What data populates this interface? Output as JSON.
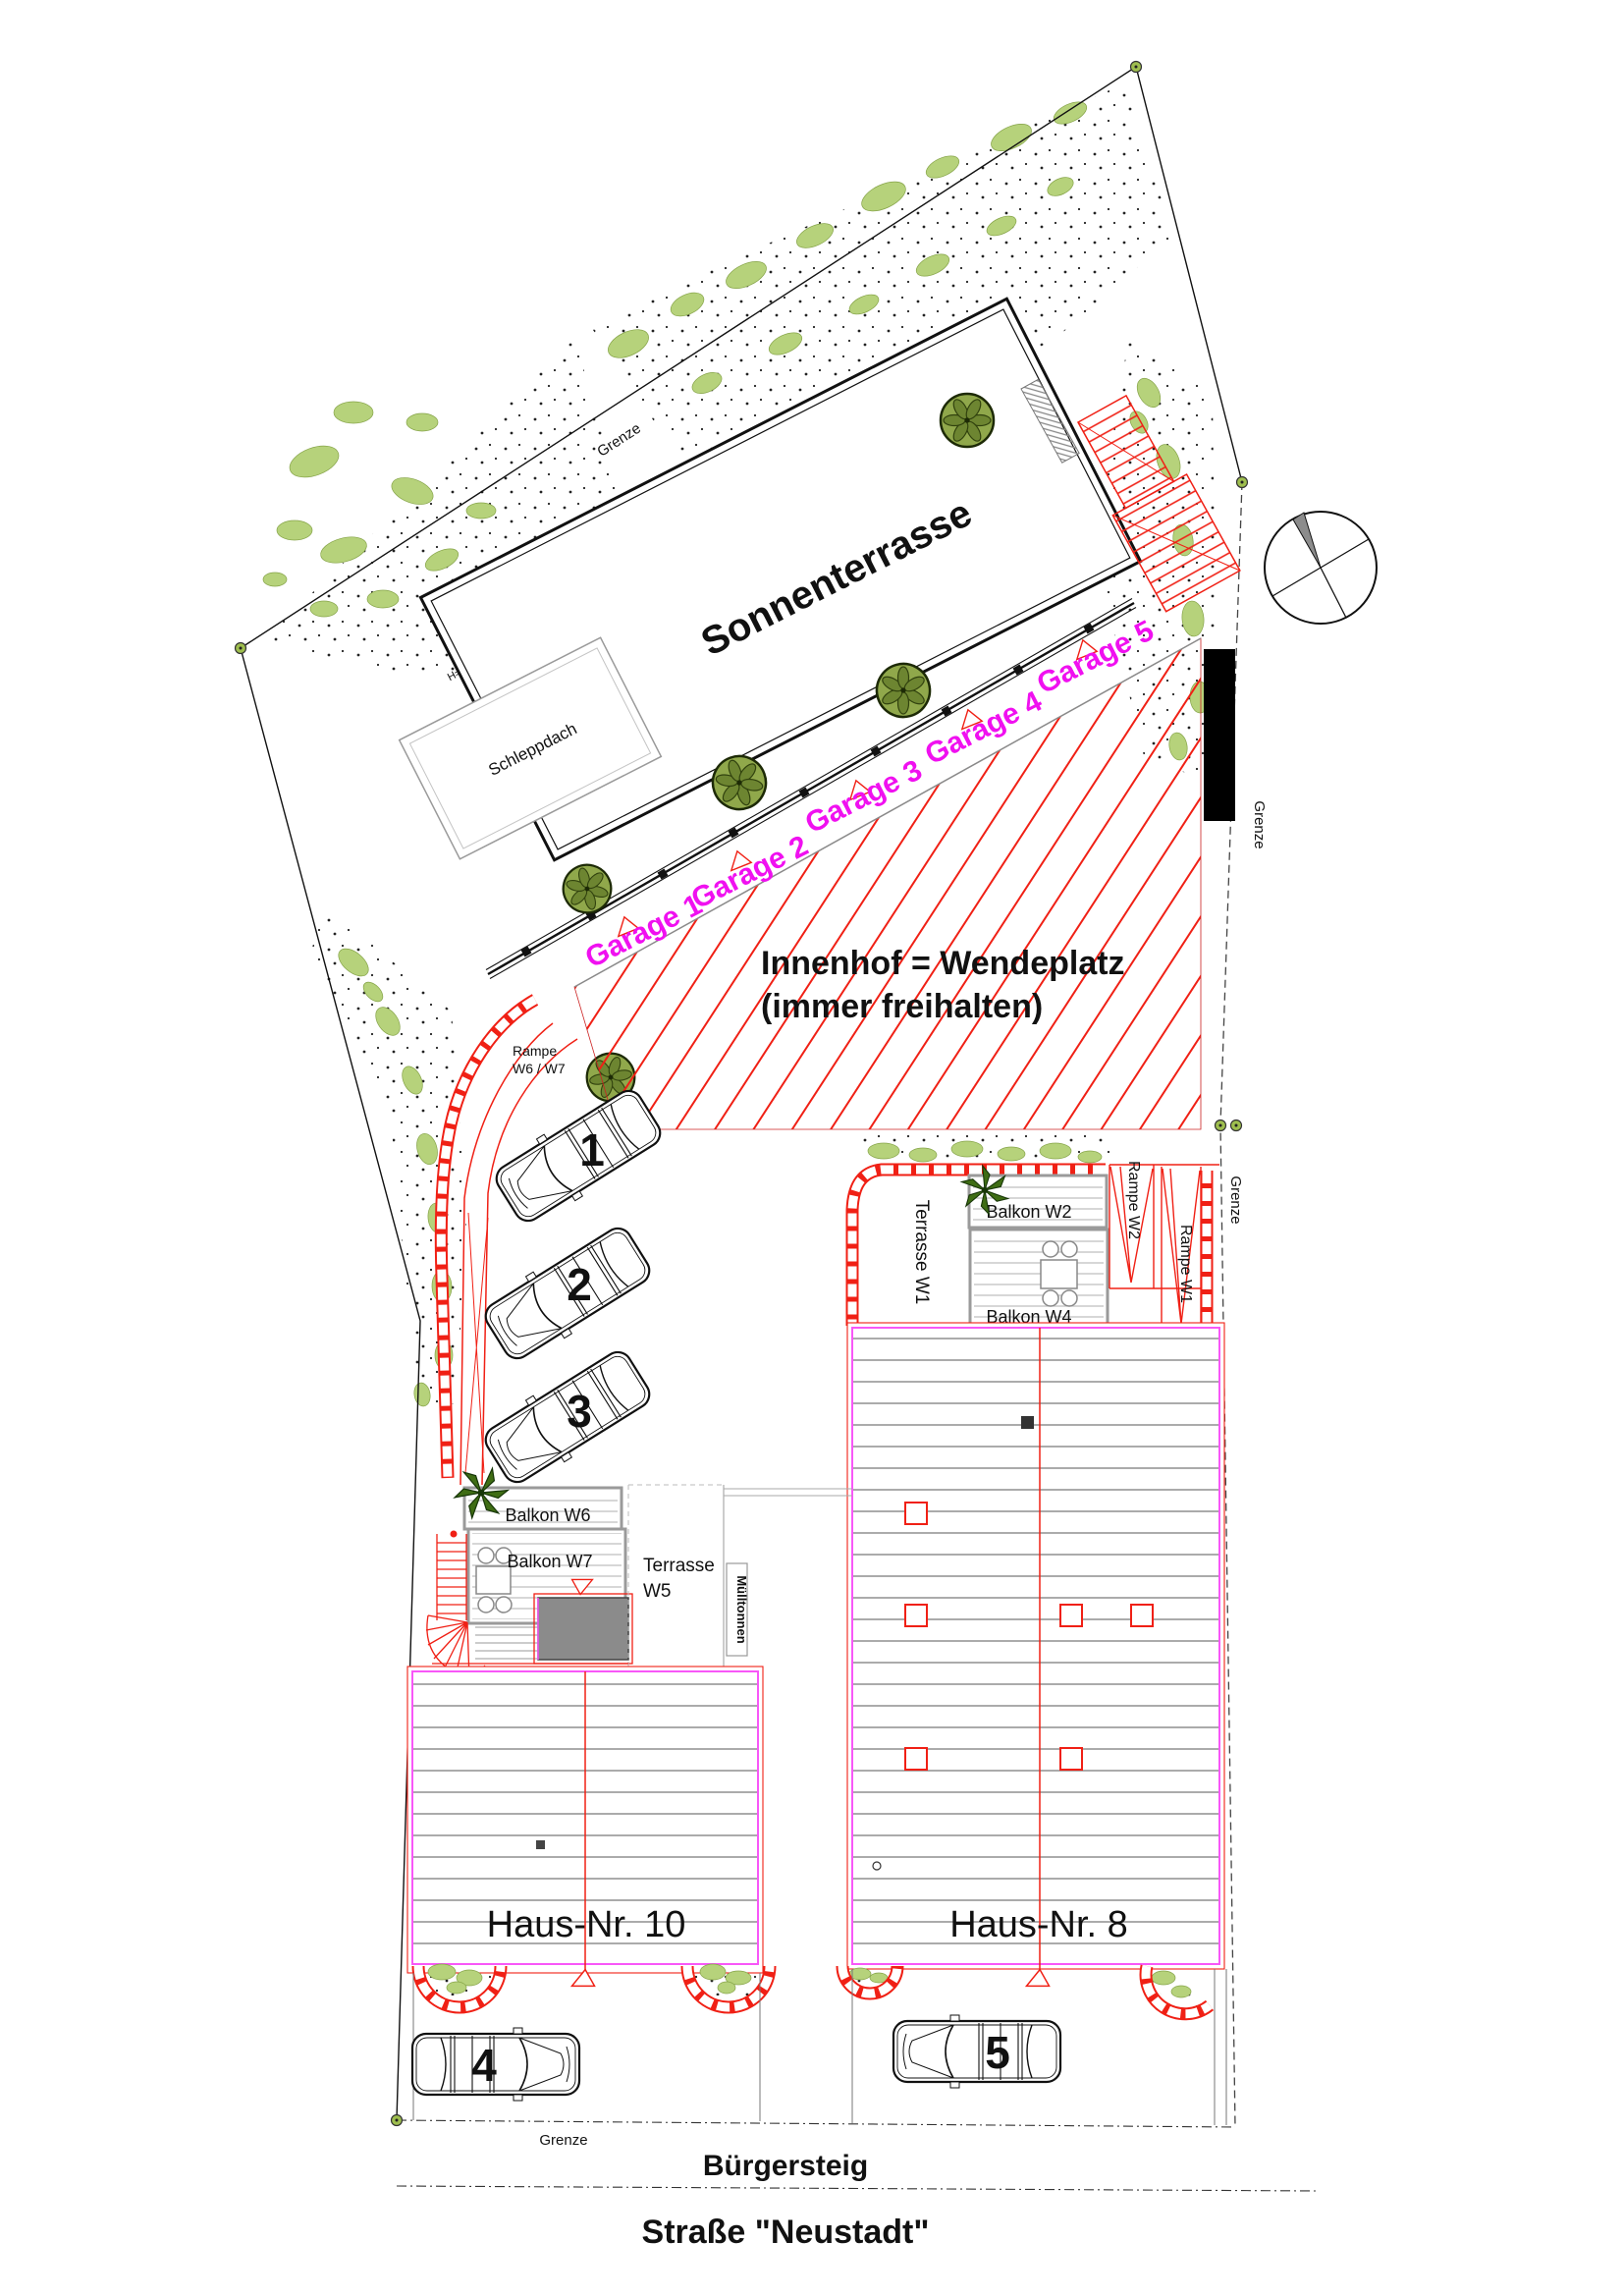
{
  "plan": {
    "areas": {
      "sonnenterrasse": "Sonnenterrasse",
      "schleppdach": "Schleppdach",
      "innenhof_line1": "Innenhof = Wendeplatz",
      "innenhof_line2": "(immer freihalten)",
      "terrasse_w1": "Terrasse W1",
      "terrasse_w5_line1": "Terrasse",
      "terrasse_w5_line2": "W5",
      "balkon_w2": "Balkon W2",
      "balkon_w4": "Balkon W4",
      "balkon_w6": "Balkon W6",
      "balkon_w7": "Balkon W7",
      "rampe_w6_w7_line1": "Rampe",
      "rampe_w6_w7_line2": "W6 / W7",
      "rampe_w2": "Rampe W2",
      "rampe_w1": "Rampe W1",
      "muelltonnen": "Mülltonnen"
    },
    "garages": [
      "Garage 1",
      "Garage 2",
      "Garage 3",
      "Garage 4",
      "Garage 5"
    ],
    "houses": {
      "haus10": "Haus-Nr. 10",
      "haus8": "Haus-Nr. 8"
    },
    "parking_numbers": [
      "1",
      "2",
      "3",
      "4",
      "5"
    ],
    "boundary_label": "Grenze",
    "heights": {
      "wall_north": "H=1.00m",
      "wall_west": "H=1.50m"
    },
    "street": {
      "sidewalk": "Bürgersteig",
      "name": "Straße \"Neustadt\""
    },
    "icons": {
      "north_arrow": "compass-circle-with-gray-north-wedge",
      "tree": "dark-green-canopy-circle",
      "plant": "palm-star-plant",
      "boundary_marker": "green-dot-marker"
    },
    "colors": {
      "accent_red": "#f02015",
      "accent_magenta": "#f010f0",
      "house_outline": "#f857f8",
      "vegetation": "#b6d27b",
      "tree": "#8aa23f",
      "wall_fill": "#000000",
      "canopy_fill": "#8b8b8b"
    }
  }
}
